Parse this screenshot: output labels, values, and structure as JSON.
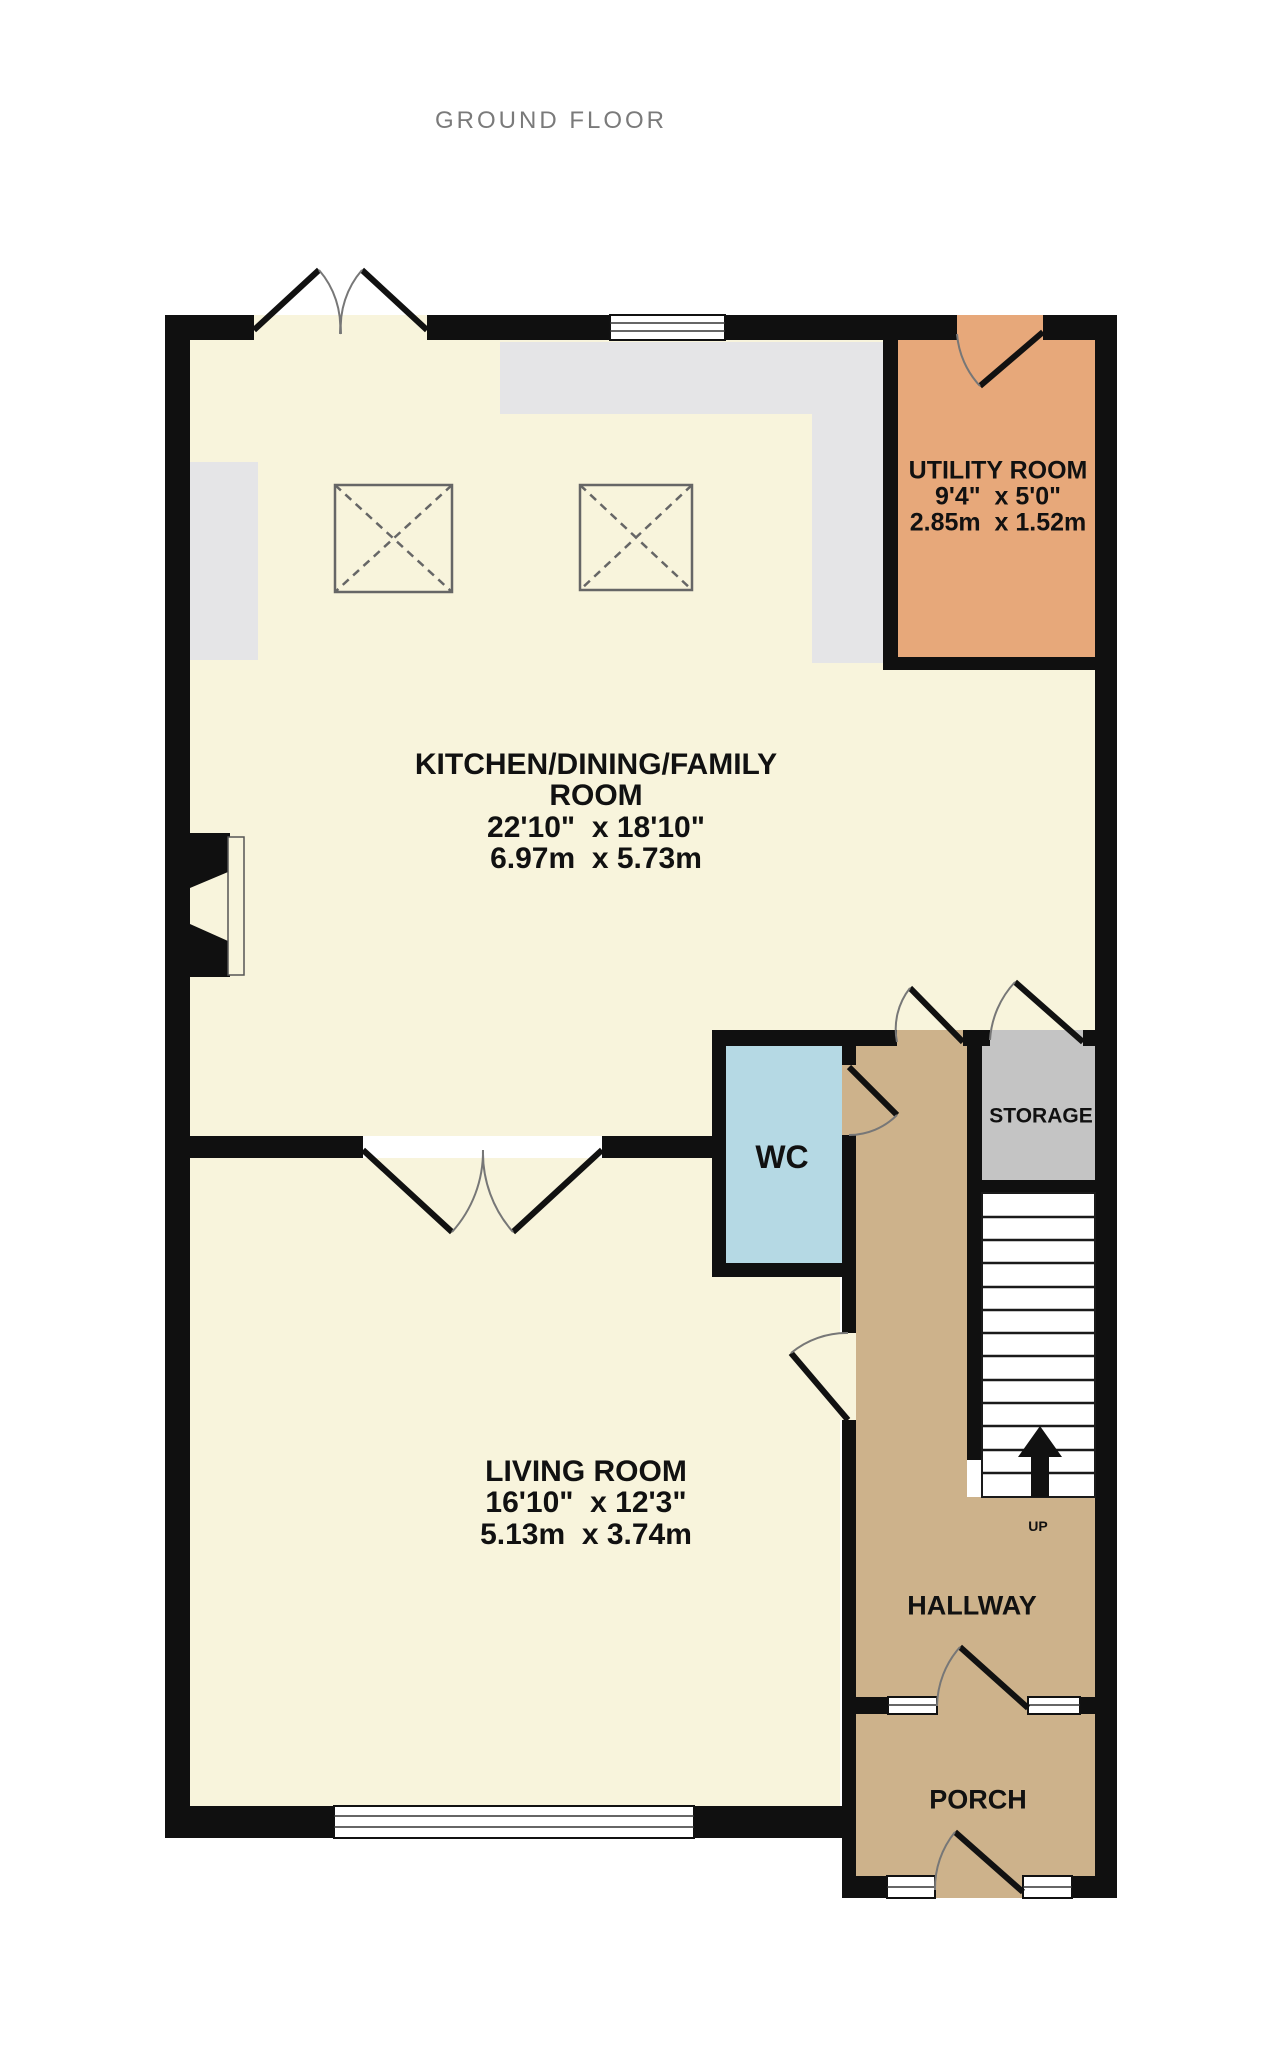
{
  "title": "GROUND FLOOR",
  "rooms": {
    "kitchen": {
      "line1": "KITCHEN/DINING/FAMILY",
      "line2": "ROOM",
      "imperial": "22'10\"  x 18'10\"",
      "metric": "6.97m  x 5.73m"
    },
    "utility": {
      "name": "UTILITY ROOM",
      "imperial": "9'4\"  x 5'0\"",
      "metric": "2.85m  x 1.52m"
    },
    "wc": {
      "name": "WC"
    },
    "storage": {
      "name": "STORAGE"
    },
    "living": {
      "name": "LIVING ROOM",
      "imperial": "16'10\"  x 12'3\"",
      "metric": "5.13m  x 3.74m"
    },
    "hallway": {
      "name": "HALLWAY"
    },
    "porch": {
      "name": "PORCH"
    }
  },
  "stairs": {
    "direction_label": "UP"
  },
  "palette": {
    "room_cream": "#f8f4dc",
    "utility_orange": "#e7a87a",
    "wc_blue": "#b5d9e4",
    "storage_gray": "#c4c4c4",
    "hall_tan": "#cdb28b",
    "counter_gray": "#e5e5e7",
    "wall_black": "#101010",
    "title_gray": "#7a7a7a"
  }
}
